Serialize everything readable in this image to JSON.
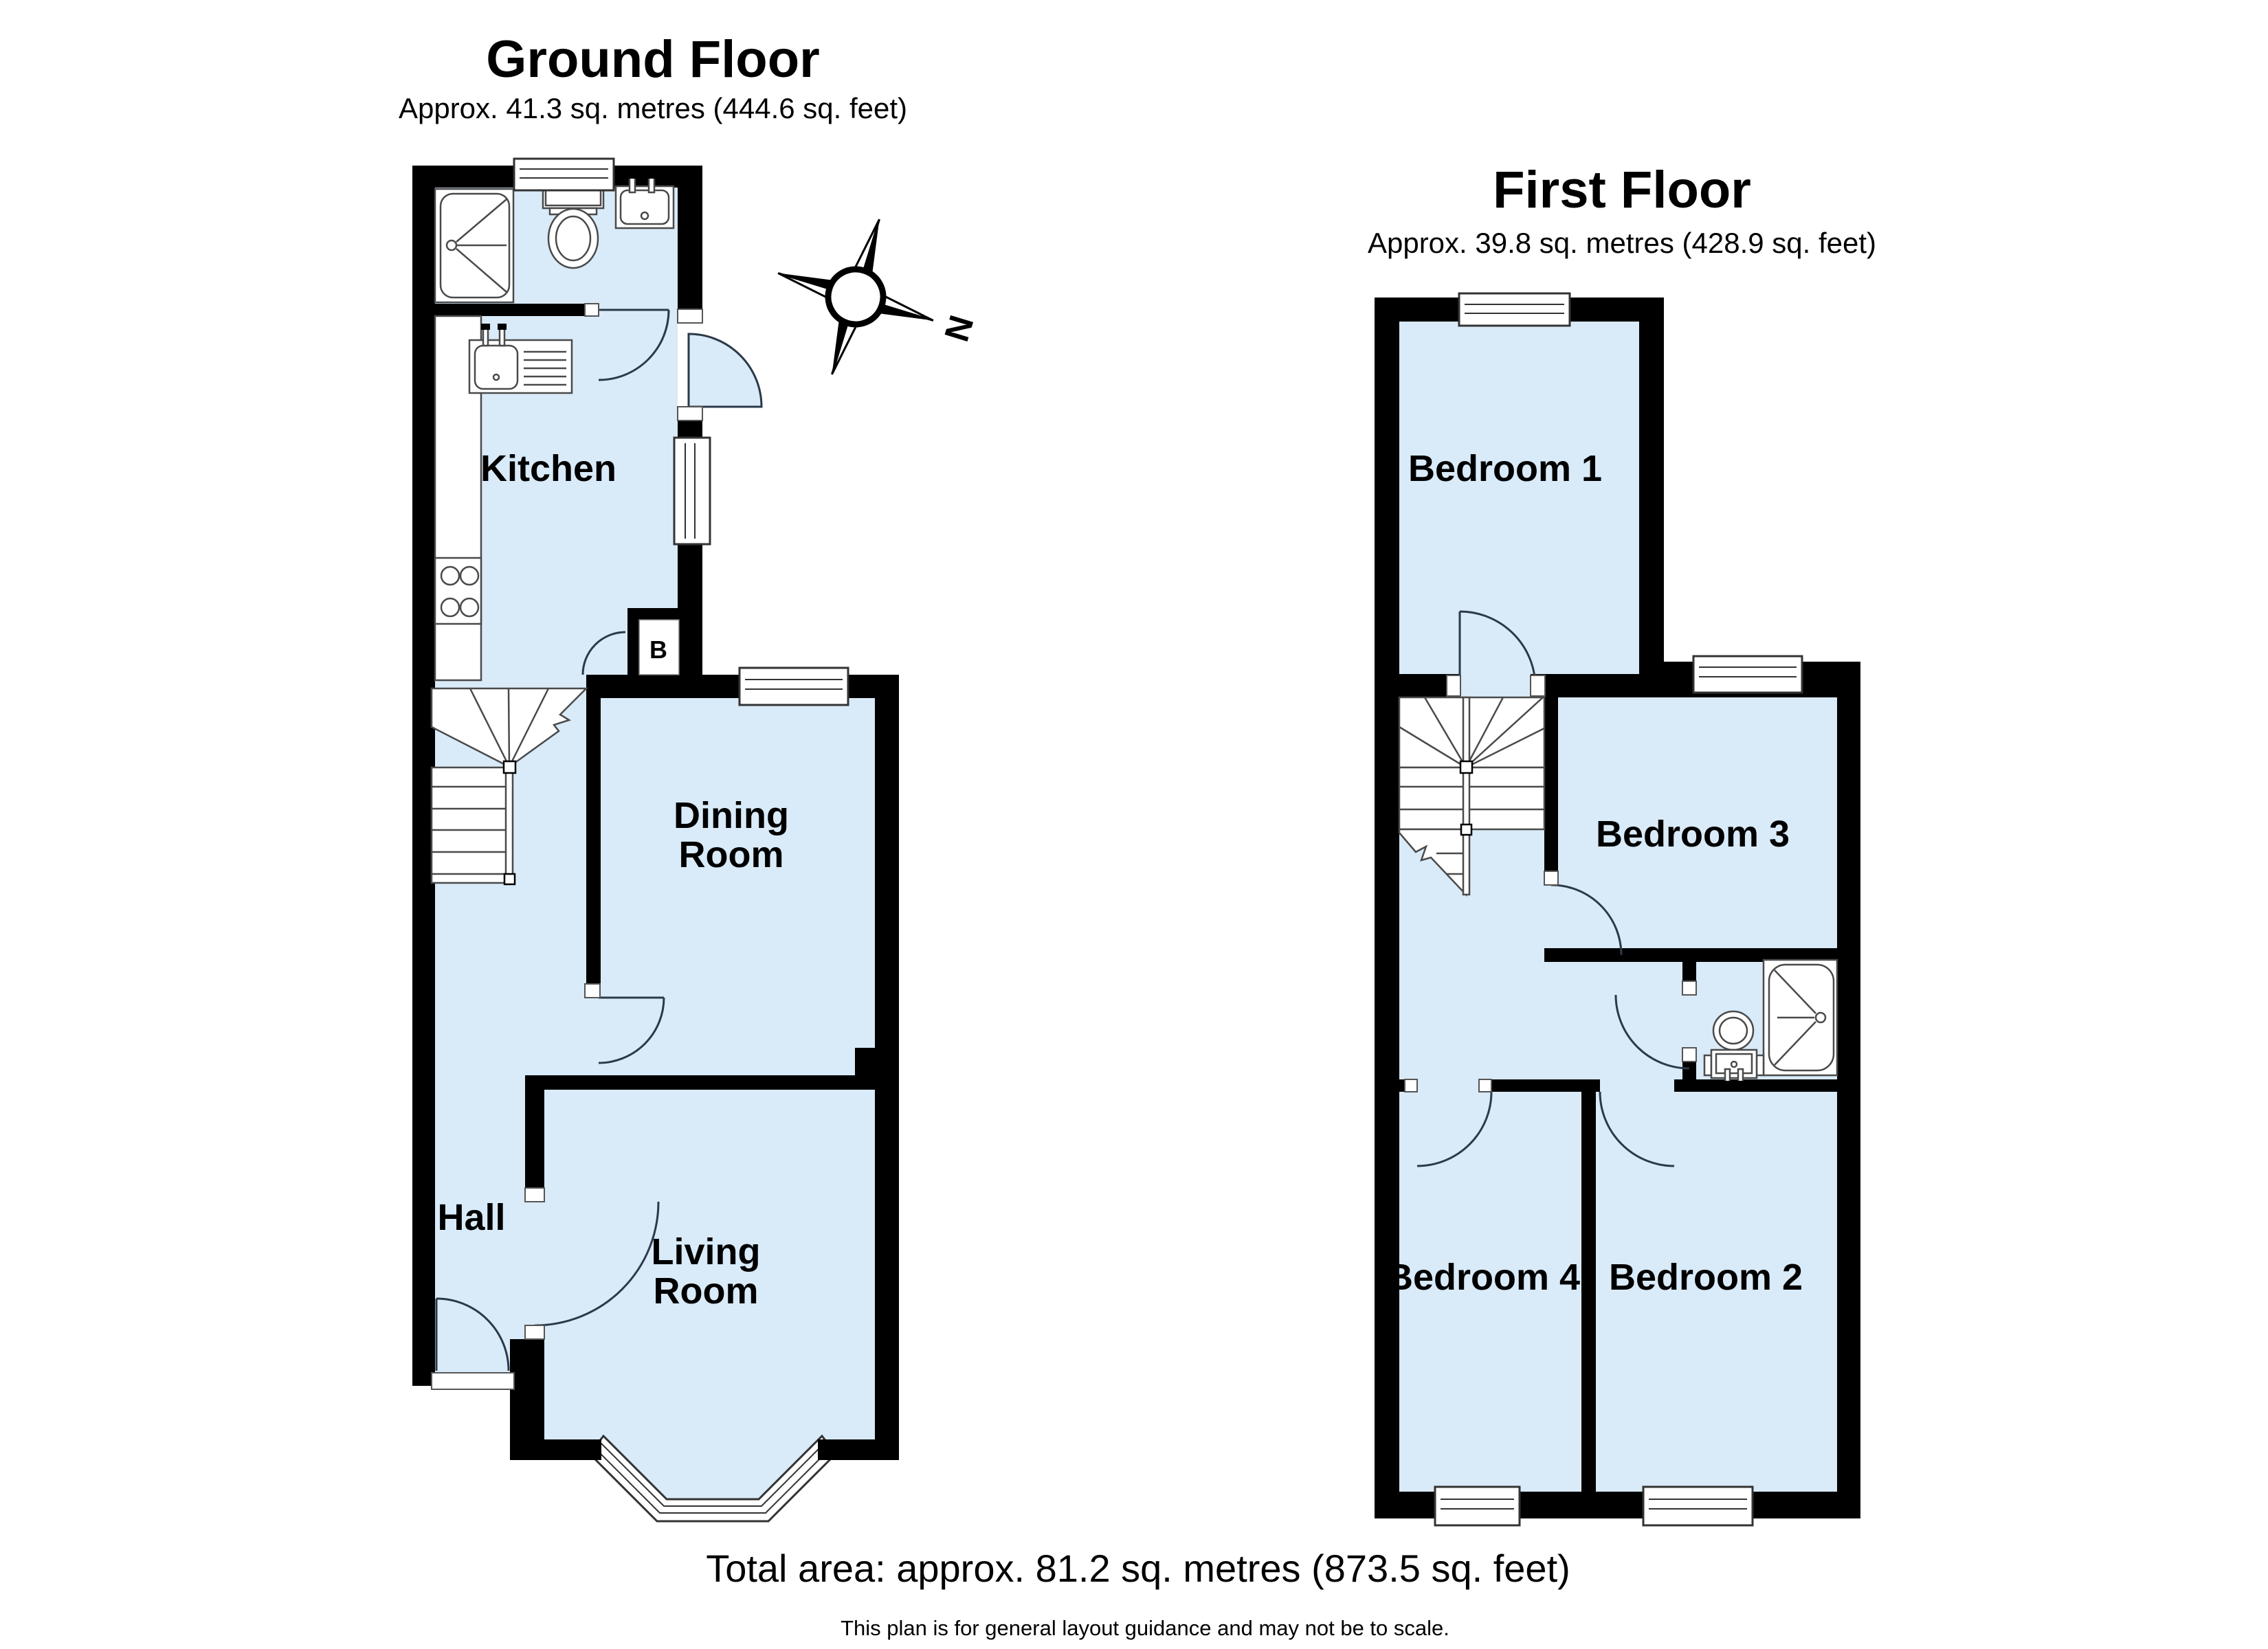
{
  "ground_floor": {
    "title": "Ground Floor",
    "subtitle": "Approx. 41.3 sq. metres (444.6 sq. feet)",
    "rooms": {
      "kitchen": "Kitchen",
      "dining_room": [
        "Dining",
        "Room"
      ],
      "hall": "Hall",
      "living_room": [
        "Living",
        "Room"
      ],
      "boiler_cupboard": "B"
    }
  },
  "first_floor": {
    "title": "First Floor",
    "subtitle": "Approx. 39.8 sq. metres (428.9 sq. feet)",
    "rooms": {
      "bedroom_1": "Bedroom 1",
      "bedroom_2": "Bedroom 2",
      "bedroom_3": "Bedroom 3",
      "bedroom_4": "Bedroom 4"
    }
  },
  "compass": {
    "north_label": "N"
  },
  "footer": {
    "total_area": "Total area: approx. 81.2 sq. metres (873.5 sq. feet)",
    "disclaimer": "This plan is for general layout guidance and may not be to scale.",
    "credit": "Plan produced using PlanUp."
  },
  "colors": {
    "floor_fill": "#d9eaf8",
    "wall": "#000000",
    "fixture_stroke": "#4a4a4a",
    "door_stroke": "#2b3a4a"
  }
}
